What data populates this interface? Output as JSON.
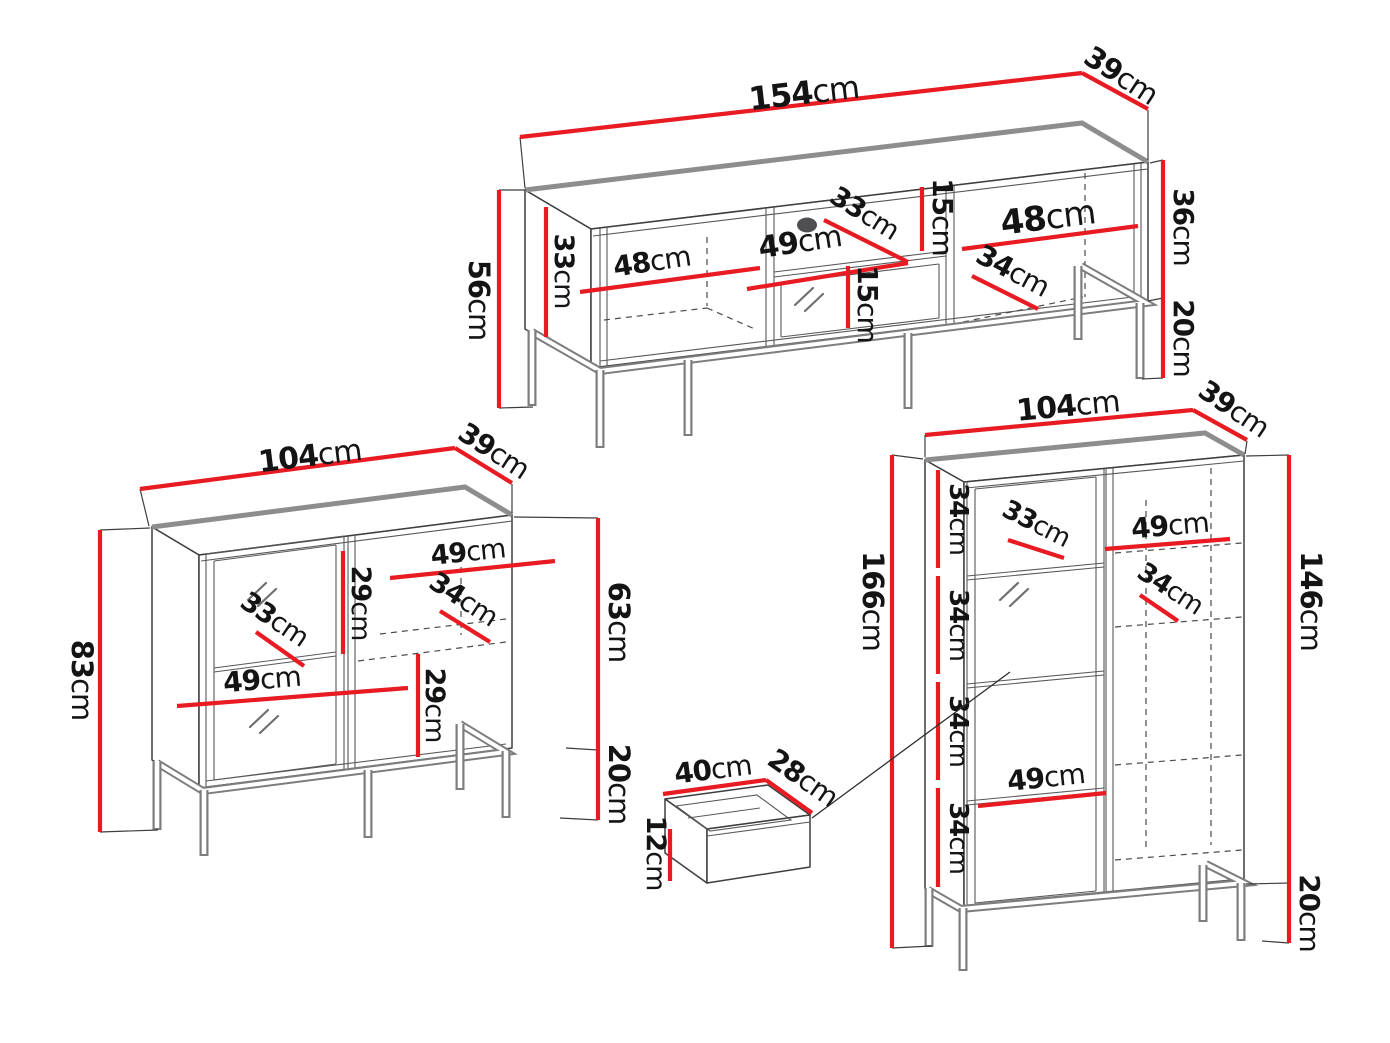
{
  "colors": {
    "dimension_red": "#e81b22",
    "outline_dark": "#3e3e40",
    "soft_gray_edge": "#8d8d8d",
    "background": "#ffffff"
  },
  "tv_stand": {
    "width": {
      "num": "154",
      "unit": "cm"
    },
    "depth": {
      "num": "39",
      "unit": "cm"
    },
    "height_total": {
      "num": "56",
      "unit": "cm"
    },
    "inner_side_height": {
      "num": "33",
      "unit": "cm"
    },
    "left_niche_width": {
      "num": "48",
      "unit": "cm"
    },
    "middle_niche_width": {
      "num": "49",
      "unit": "cm"
    },
    "middle_shelf_depth": {
      "num": "33",
      "unit": "cm"
    },
    "middle_top_niche_height": {
      "num": "15",
      "unit": "cm"
    },
    "middle_bottom_niche_height": {
      "num": "15",
      "unit": "cm"
    },
    "right_niche_width": {
      "num": "48",
      "unit": "cm"
    },
    "right_shelf_depth": {
      "num": "34",
      "unit": "cm"
    },
    "carcass_height": {
      "num": "36",
      "unit": "cm"
    },
    "leg_height": {
      "num": "20",
      "unit": "cm"
    }
  },
  "sideboard": {
    "width": {
      "num": "104",
      "unit": "cm"
    },
    "depth": {
      "num": "39",
      "unit": "cm"
    },
    "height_total": {
      "num": "83",
      "unit": "cm"
    },
    "upper_niche_height": {
      "num": "29",
      "unit": "cm"
    },
    "glass_shelf_depth": {
      "num": "33",
      "unit": "cm"
    },
    "left_niche_width": {
      "num": "49",
      "unit": "cm"
    },
    "right_shelf_depth": {
      "num": "34",
      "unit": "cm"
    },
    "right_niche_width": {
      "num": "49",
      "unit": "cm"
    },
    "lower_niche_height": {
      "num": "29",
      "unit": "cm"
    },
    "carcass_height": {
      "num": "63",
      "unit": "cm"
    },
    "leg_height": {
      "num": "20",
      "unit": "cm"
    }
  },
  "display_cabinet": {
    "width": {
      "num": "104",
      "unit": "cm"
    },
    "depth": {
      "num": "39",
      "unit": "cm"
    },
    "height_total": {
      "num": "166",
      "unit": "cm"
    },
    "shelf_gaps": [
      {
        "num": "34",
        "unit": "cm"
      },
      {
        "num": "34",
        "unit": "cm"
      },
      {
        "num": "34",
        "unit": "cm"
      },
      {
        "num": "34",
        "unit": "cm"
      }
    ],
    "glass_shelf_depth": {
      "num": "33",
      "unit": "cm"
    },
    "right_niche_width": {
      "num": "49",
      "unit": "cm"
    },
    "right_shelf_depth": {
      "num": "34",
      "unit": "cm"
    },
    "left_niche_width": {
      "num": "49",
      "unit": "cm"
    },
    "carcass_height": {
      "num": "146",
      "unit": "cm"
    },
    "leg_height": {
      "num": "20",
      "unit": "cm"
    }
  },
  "drawer": {
    "width": {
      "num": "40",
      "unit": "cm"
    },
    "depth": {
      "num": "28",
      "unit": "cm"
    },
    "height": {
      "num": "12",
      "unit": "cm"
    }
  }
}
